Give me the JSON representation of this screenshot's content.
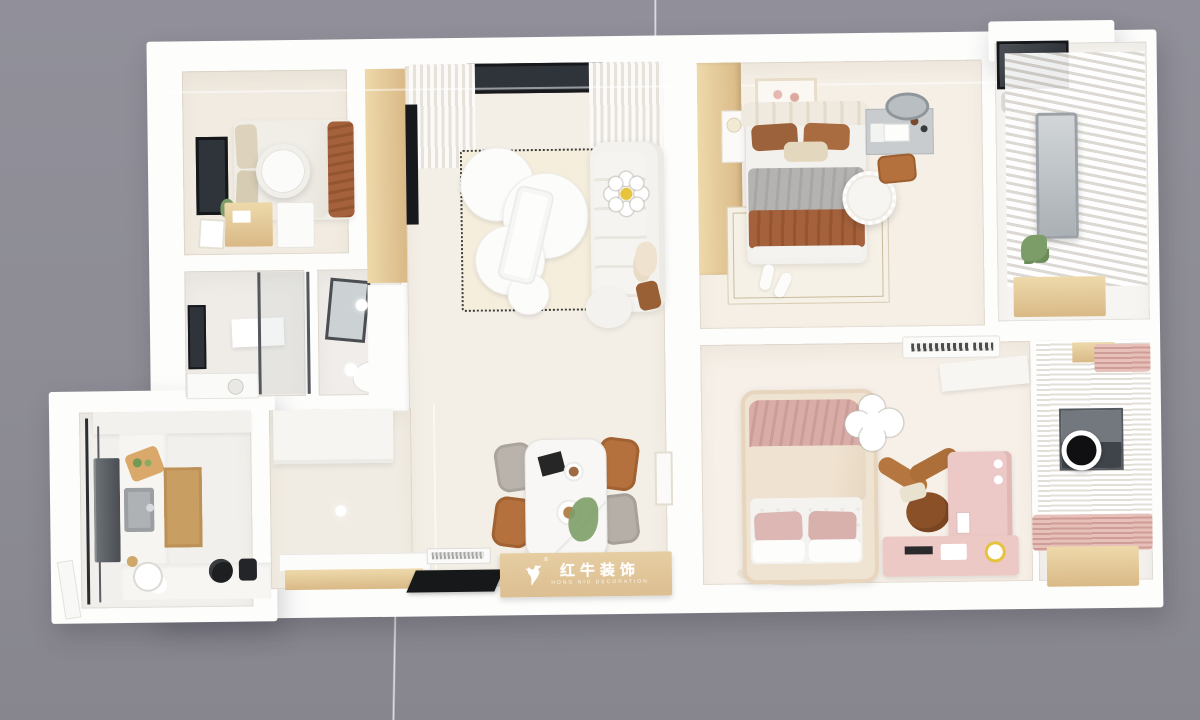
{
  "watermark": {
    "brand_cn": "红牛装饰",
    "brand_en": "HONG NIU DECORATION",
    "registered": "®"
  },
  "palette": {
    "background": "#8d8c94",
    "wall_white": "#fdfdfc",
    "floor_cream": "#f3eee6",
    "floor_warm": "#f1ebe1",
    "rug_cream": "#f5eedd",
    "wood_light": "#eed9ab",
    "wood": "#d9b986",
    "wood_deep": "#c99e62",
    "brown_blanket": "#a4613c",
    "caramel_chair": "#b4713d",
    "gray_fabric": "#b5b3b2",
    "pink_soft": "#ecc9c6",
    "pink_deep": "#d9aca7",
    "window_dark": "#2f343a",
    "steel_gray": "#aeb2b5",
    "plant_green": "#7d9d68",
    "lamp_yellow": "#e8c43c",
    "logo_wood": "#dcbf92"
  }
}
